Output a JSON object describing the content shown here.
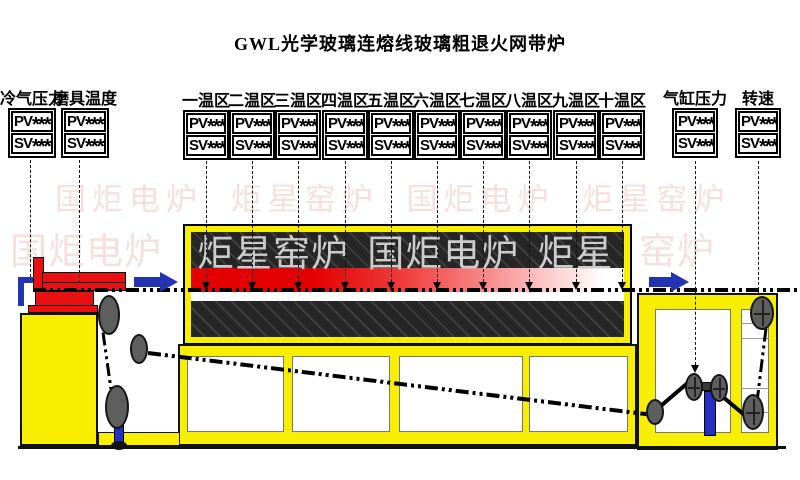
{
  "title": "GWL光学玻璃连熔线玻璃粗退火网带炉",
  "watermarks": {
    "row1": "国炬电炉 炬星窑炉  国炬电炉 炬星窑炉",
    "row2_left": "国炬电炉",
    "row2_on_furnace": "炬星窑炉 国炬电炉 炬星",
    "row2_right": "窑炉",
    "pink": "#f5e0e0",
    "gray_on_black": "#cccccc"
  },
  "gauges": {
    "pv_label": "PV",
    "sv_label": "SV",
    "left": [
      {
        "label": "冷气压力",
        "pv": "****",
        "sv": "****"
      },
      {
        "label": "磨具温度",
        "pv": "****",
        "sv": "****"
      }
    ],
    "zones": [
      {
        "label": "一温区",
        "pv": "****",
        "sv": "****"
      },
      {
        "label": "二温区",
        "pv": "****",
        "sv": "****"
      },
      {
        "label": "三温区",
        "pv": "****",
        "sv": "****"
      },
      {
        "label": "四温区",
        "pv": "****",
        "sv": "****"
      },
      {
        "label": "五温区",
        "pv": "****",
        "sv": "****"
      },
      {
        "label": "六温区",
        "pv": "****",
        "sv": "****"
      },
      {
        "label": "七温区",
        "pv": "****",
        "sv": "****"
      },
      {
        "label": "八温区",
        "pv": "****",
        "sv": "****"
      },
      {
        "label": "九温区",
        "pv": "****",
        "sv": "****"
      },
      {
        "label": "十温区",
        "pv": "****",
        "sv": "****"
      }
    ],
    "right": [
      {
        "label": "气缸压力",
        "pv": "****",
        "sv": "****"
      },
      {
        "label": "转速",
        "pv": "****",
        "sv": "****"
      }
    ]
  },
  "colors": {
    "frame_yellow": "#f8ee00",
    "heater_red": "#e30000",
    "flow_arrow_blue": "#2433b2",
    "furnace_black": "#262626",
    "belt_black": "#000000"
  }
}
